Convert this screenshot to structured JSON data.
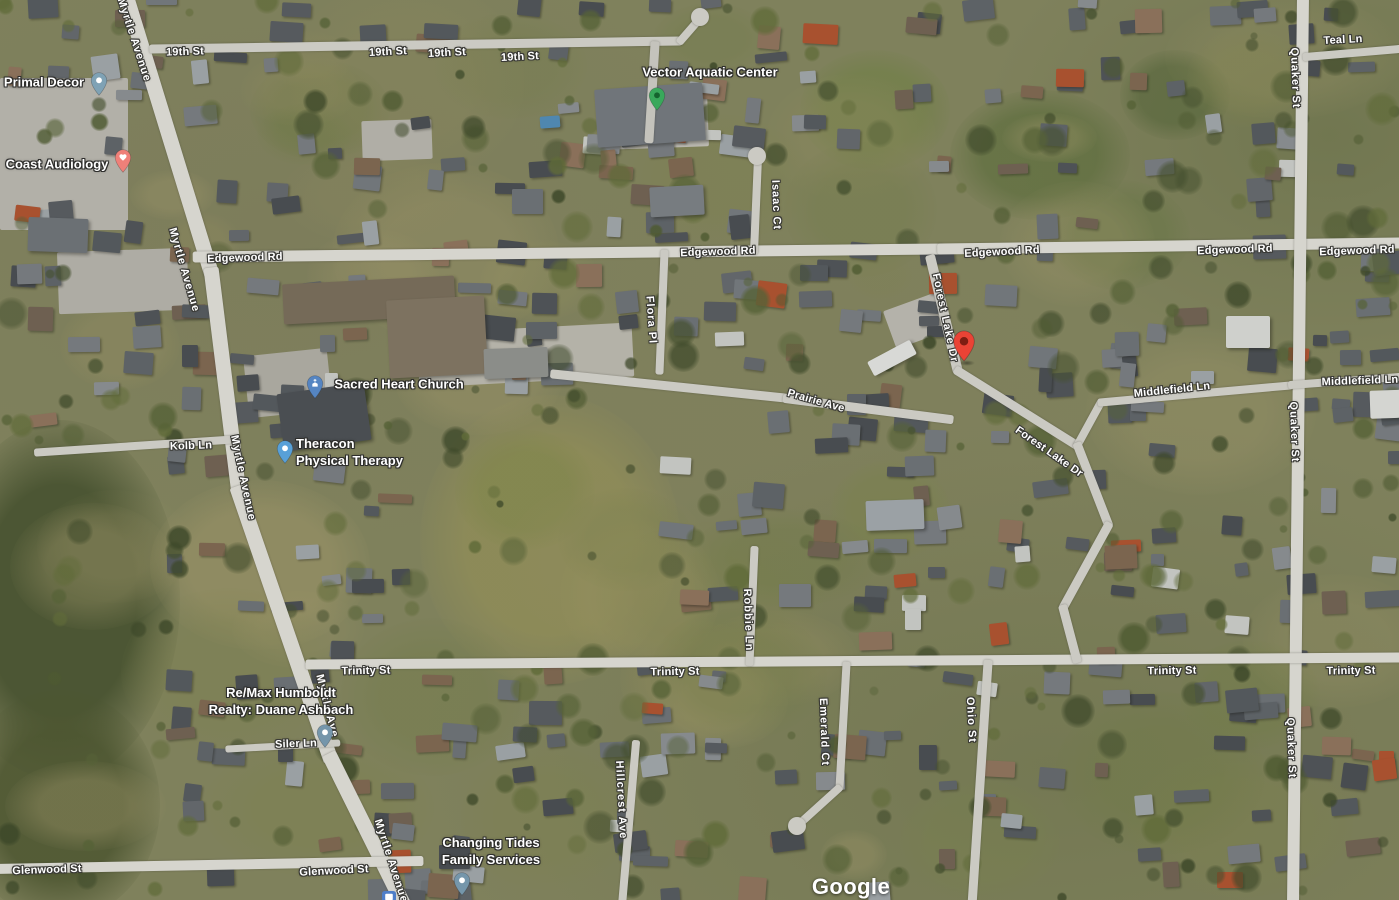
{
  "map": {
    "attribution": "Google",
    "street_labels": [
      {
        "text": "19th St",
        "x": 185,
        "y": 52,
        "rotate": -2
      },
      {
        "text": "19th St",
        "x": 388,
        "y": 52,
        "rotate": -3
      },
      {
        "text": "19th St",
        "x": 447,
        "y": 53,
        "rotate": -3
      },
      {
        "text": "19th St",
        "x": 520,
        "y": 57,
        "rotate": -3
      },
      {
        "text": "Edgewood Rd",
        "x": 245,
        "y": 258,
        "rotate": -2
      },
      {
        "text": "Edgewood Rd",
        "x": 718,
        "y": 252,
        "rotate": -2
      },
      {
        "text": "Edgewood Rd",
        "x": 1002,
        "y": 252,
        "rotate": -3
      },
      {
        "text": "Edgewood Rd",
        "x": 1235,
        "y": 250,
        "rotate": -2
      },
      {
        "text": "Edgewood Rd",
        "x": 1357,
        "y": 251,
        "rotate": -2
      },
      {
        "text": "Myrtle Avenue",
        "x": 134,
        "y": 40,
        "rotate": 72
      },
      {
        "text": "Myrtle Avenue",
        "x": 184,
        "y": 270,
        "rotate": 74
      },
      {
        "text": "Myrtle Avenue",
        "x": 243,
        "y": 478,
        "rotate": 78
      },
      {
        "text": "Myrtle Ave",
        "x": 327,
        "y": 706,
        "rotate": 76
      },
      {
        "text": "Myrtle Avenue",
        "x": 391,
        "y": 861,
        "rotate": 72
      },
      {
        "text": "Teal Ln",
        "x": 1343,
        "y": 40,
        "rotate": -3
      },
      {
        "text": "Quaker St",
        "x": 1295,
        "y": 78,
        "rotate": 88
      },
      {
        "text": "Quaker St",
        "x": 1294,
        "y": 432,
        "rotate": 88
      },
      {
        "text": "Quaker St",
        "x": 1291,
        "y": 748,
        "rotate": 88
      },
      {
        "text": "Middlefield Ln",
        "x": 1172,
        "y": 390,
        "rotate": -6
      },
      {
        "text": "Middlefield Ln",
        "x": 1360,
        "y": 381,
        "rotate": -2
      },
      {
        "text": "Isaac Ct",
        "x": 776,
        "y": 205,
        "rotate": 88
      },
      {
        "text": "Flora Pl",
        "x": 651,
        "y": 320,
        "rotate": 86
      },
      {
        "text": "Prairie Ave",
        "x": 816,
        "y": 401,
        "rotate": 16
      },
      {
        "text": "Forest Lake Dr",
        "x": 945,
        "y": 318,
        "rotate": 78
      },
      {
        "text": "Forest Lake Dr",
        "x": 1049,
        "y": 452,
        "rotate": 35
      },
      {
        "text": "Kolb Ln",
        "x": 191,
        "y": 446,
        "rotate": -2
      },
      {
        "text": "Trinity St",
        "x": 366,
        "y": 671,
        "rotate": -1
      },
      {
        "text": "Trinity St",
        "x": 675,
        "y": 672,
        "rotate": -1
      },
      {
        "text": "Trinity St",
        "x": 1172,
        "y": 671,
        "rotate": -1
      },
      {
        "text": "Trinity St",
        "x": 1351,
        "y": 671,
        "rotate": -1
      },
      {
        "text": "Robbie Ln",
        "x": 748,
        "y": 620,
        "rotate": 88
      },
      {
        "text": "Ohio St",
        "x": 971,
        "y": 720,
        "rotate": 87
      },
      {
        "text": "Emerald Ct",
        "x": 824,
        "y": 732,
        "rotate": 88
      },
      {
        "text": "Hillcrest Ave",
        "x": 621,
        "y": 800,
        "rotate": 87
      },
      {
        "text": "Glenwood St",
        "x": 47,
        "y": 870,
        "rotate": -2
      },
      {
        "text": "Glenwood St",
        "x": 334,
        "y": 871,
        "rotate": -3
      },
      {
        "text": "Siler Ln",
        "x": 296,
        "y": 744,
        "rotate": -2
      }
    ],
    "pois": [
      {
        "id": "primal-decor",
        "lines": [
          "Primal Decor"
        ],
        "label_x": 44,
        "label_y": 82,
        "align": "center",
        "marker_color": "#7fa2b5",
        "marker_inner": "dot",
        "marker_x": 99,
        "marker_y": 96
      },
      {
        "id": "coast-audiology",
        "lines": [
          "Coast Audiology"
        ],
        "label_x": 57,
        "label_y": 164,
        "align": "center",
        "marker_color": "#ef8079",
        "marker_inner": "heart",
        "marker_x": 123,
        "marker_y": 173
      },
      {
        "id": "vector-aquatic-center",
        "lines": [
          "Vector Aquatic Center"
        ],
        "label_x": 710,
        "label_y": 72,
        "align": "center",
        "marker_color": "#39a85b",
        "marker_inner": "dot-dark",
        "marker_x": 657,
        "marker_y": 111
      },
      {
        "id": "sacred-heart-church",
        "lines": [
          "Sacred Heart Church"
        ],
        "label_x": 399,
        "label_y": 384,
        "align": "center",
        "marker_color": "#5585c2",
        "marker_inner": "church",
        "marker_x": 315,
        "marker_y": 399
      },
      {
        "id": "theracon-physical-therapy",
        "lines": [
          "Theracon",
          "Physical Therapy"
        ],
        "label_x": 296,
        "label_y": 452,
        "align": "left",
        "marker_color": "#58a0d8",
        "marker_inner": "dot",
        "marker_x": 285,
        "marker_y": 464
      },
      {
        "id": "remax-humboldt-realty-duane-ashbach",
        "lines": [
          "Re/Max Humboldt",
          "Realty: Duane Ashbach"
        ],
        "label_x": 281,
        "label_y": 701,
        "align": "center",
        "marker_color": "#7596ab",
        "marker_inner": "dot",
        "marker_x": 325,
        "marker_y": 748
      },
      {
        "id": "changing-tides-family-services",
        "lines": [
          "Changing Tides",
          "Family Services"
        ],
        "label_x": 491,
        "label_y": 851,
        "align": "center",
        "marker_color": "#7596ab",
        "marker_inner": "dot",
        "marker_x": 462,
        "marker_y": 896
      }
    ],
    "destination_pin": {
      "x": 964,
      "y": 362,
      "color": "#EA4335",
      "inner_color": "#7E1D12"
    },
    "transit_icon": {
      "x": 382,
      "y": 891,
      "color": "#4f7fc9"
    }
  },
  "colors": {
    "road_major": "#d6d5ce",
    "road_minor": "#cbcac3",
    "driveway": "#c4c3bc",
    "label_text": "#ffffff"
  }
}
